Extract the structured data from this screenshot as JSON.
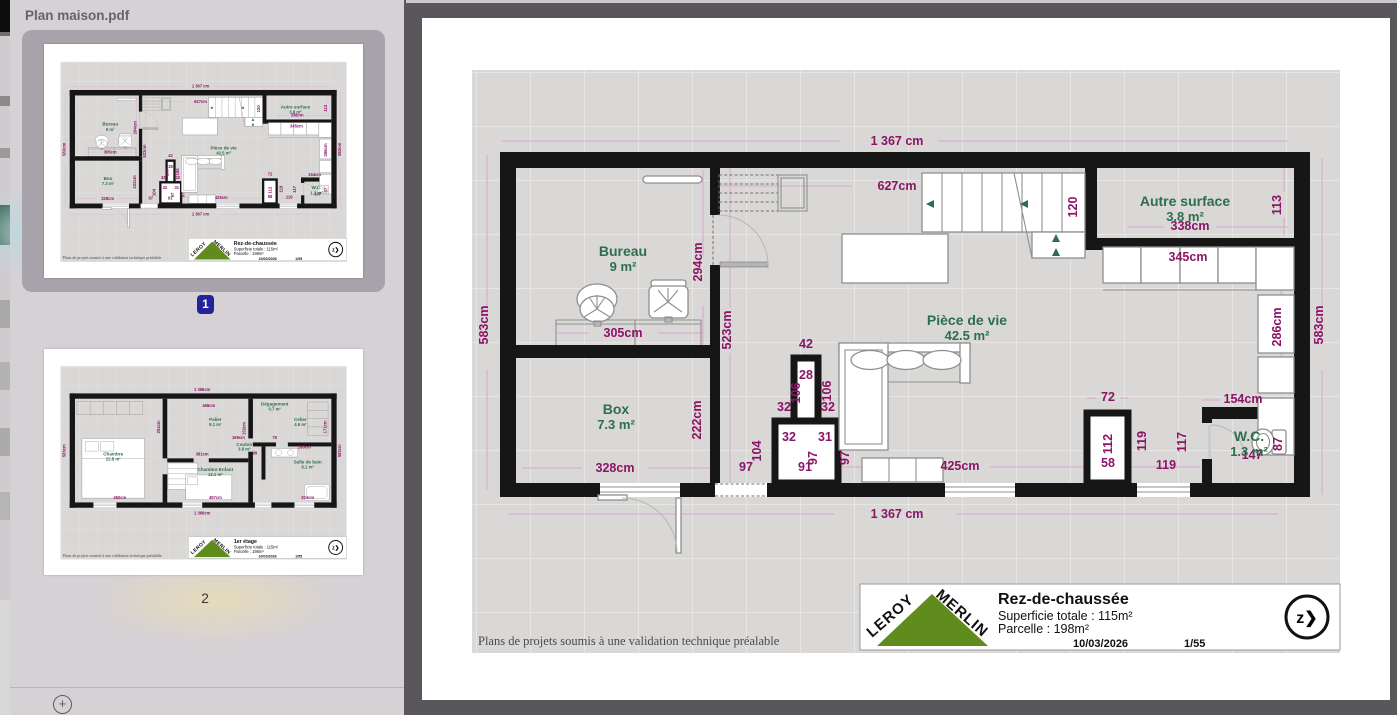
{
  "window": {
    "sidebar_title": "Plan maison.pdf"
  },
  "sidebar": {
    "pages": [
      {
        "number": "1",
        "selected": true
      },
      {
        "number": "2",
        "selected": false
      }
    ]
  },
  "colors": {
    "dimension_text": "#8c1468",
    "room_text": "#2c6e4e",
    "wall": "#161616",
    "page_badge_blue": "#23239b",
    "logo_green": "#5f8c1d",
    "viewer_background": "#59575b"
  },
  "page1": {
    "footer_note": "Plans de projets soumis à une validation technique préalable",
    "title_block": {
      "brand_top": "LEROY",
      "brand_bottom": "MERLIN",
      "title": "Rez-de-chaussée",
      "line1": "Superficie totale : 115m²",
      "line2": "Parcelle : 198m²",
      "date": "10/03/2026",
      "page_ref": "1/55",
      "compass": "z❯"
    },
    "rooms": [
      {
        "name": "Bureau",
        "area": "9 m²",
        "x": 201,
        "y": 238
      },
      {
        "name": "Box",
        "area": "7.3 m²",
        "x": 194,
        "y": 396
      },
      {
        "name": "Pièce de vie",
        "area": "42.5 m²",
        "x": 545,
        "y": 307
      },
      {
        "name": "Autre surface",
        "area": "3.8 m²",
        "x": 763,
        "y": 188
      },
      {
        "name": "W.C.",
        "area": "1.3 m²",
        "x": 827,
        "y": 423
      }
    ],
    "dims": [
      {
        "t": "1 367 cm",
        "x": 475,
        "y": 127
      },
      {
        "t": "1 367 cm",
        "x": 475,
        "y": 500
      },
      {
        "t": "583cm",
        "x": 66,
        "y": 307,
        "r": -90
      },
      {
        "t": "583cm",
        "x": 901,
        "y": 307,
        "r": -90
      },
      {
        "t": "627cm",
        "x": 475,
        "y": 172
      },
      {
        "t": "294cm",
        "x": 280,
        "y": 244,
        "r": -90
      },
      {
        "t": "523cm",
        "x": 309,
        "y": 312,
        "r": -90
      },
      {
        "t": "305cm",
        "x": 201,
        "y": 319
      },
      {
        "t": "222cm",
        "x": 279,
        "y": 402,
        "r": -90
      },
      {
        "t": "328cm",
        "x": 193,
        "y": 454
      },
      {
        "t": "120",
        "x": 655,
        "y": 189,
        "r": -90
      },
      {
        "t": "113",
        "x": 859,
        "y": 187,
        "r": -90
      },
      {
        "t": "42",
        "x": 384,
        "y": 330
      },
      {
        "t": "28",
        "x": 384,
        "y": 361
      },
      {
        "t": "106",
        "x": 378,
        "y": 375,
        "r": -90
      },
      {
        "t": "106",
        "x": 409,
        "y": 373,
        "r": -90
      },
      {
        "t": "32",
        "x": 362,
        "y": 393
      },
      {
        "t": "32",
        "x": 406,
        "y": 393
      },
      {
        "t": "32",
        "x": 367,
        "y": 423
      },
      {
        "t": "31",
        "x": 403,
        "y": 423
      },
      {
        "t": "104",
        "x": 339,
        "y": 433,
        "r": -90
      },
      {
        "t": "97",
        "x": 324,
        "y": 453
      },
      {
        "t": "97",
        "x": 395,
        "y": 440,
        "r": -90
      },
      {
        "t": "97",
        "x": 427,
        "y": 440,
        "r": -90
      },
      {
        "t": "91",
        "x": 383,
        "y": 453
      },
      {
        "t": "425cm",
        "x": 538,
        "y": 452
      },
      {
        "t": "345cm",
        "x": 766,
        "y": 243
      },
      {
        "t": "338cm",
        "x": 768,
        "y": 212
      },
      {
        "t": "286cm",
        "x": 859,
        "y": 309,
        "r": -90
      },
      {
        "t": "154cm",
        "x": 821,
        "y": 385
      },
      {
        "t": "72",
        "x": 686,
        "y": 383
      },
      {
        "t": "112",
        "x": 690,
        "y": 426,
        "r": -90
      },
      {
        "t": "58",
        "x": 686,
        "y": 449
      },
      {
        "t": "119",
        "x": 724,
        "y": 423,
        "r": -90
      },
      {
        "t": "117",
        "x": 764,
        "y": 424,
        "r": -90
      },
      {
        "t": "119",
        "x": 744,
        "y": 451
      },
      {
        "t": "147",
        "x": 830,
        "y": 441
      },
      {
        "t": "87",
        "x": 860,
        "y": 426,
        "r": -90
      }
    ]
  },
  "page2": {
    "footer_note": "Plans de projets soumis à une validation technique préalable",
    "title_block": {
      "brand_top": "LEROY",
      "brand_bottom": "MERLIN",
      "title": "1er étage",
      "line1": "Superficie totale : 115m²",
      "line2": "Parcelle : 198m²",
      "date": "10/03/2026",
      "page_ref": "1/55",
      "compass": "z❯"
    },
    "rooms": [
      {
        "name": "Chambre",
        "area": "22.8 m²",
        "x": 210,
        "y": 322
      },
      {
        "name": "Palier",
        "area": "9.1 m²",
        "x": 520,
        "y": 218
      },
      {
        "name": "Chambre Enfant",
        "area": "12.1 m²",
        "x": 520,
        "y": 368
      },
      {
        "name": "Celier",
        "area": "4.9 m²",
        "x": 778,
        "y": 218
      },
      {
        "name": "Salle de bain",
        "area": "6.1 m²",
        "x": 800,
        "y": 345
      },
      {
        "name": "Dégagement",
        "area": "0.7 m²",
        "x": 700,
        "y": 170
      },
      {
        "name": "Couloir",
        "area": "3.8 m²",
        "x": 608,
        "y": 292
      }
    ],
    "dims": [
      {
        "t": "1 366cm",
        "x": 480,
        "y": 127
      },
      {
        "t": "1 366cm",
        "x": 480,
        "y": 500
      },
      {
        "t": "583cm",
        "x": 66,
        "y": 307,
        "r": -90
      },
      {
        "t": "583cm",
        "x": 901,
        "y": 307,
        "r": -90
      },
      {
        "t": "468cm",
        "x": 500,
        "y": 175
      },
      {
        "t": "254cm",
        "x": 352,
        "y": 235,
        "r": -90
      },
      {
        "t": "381cm",
        "x": 480,
        "y": 322
      },
      {
        "t": "169cm",
        "x": 590,
        "y": 272
      },
      {
        "t": "152cm",
        "x": 612,
        "y": 240,
        "r": -90
      },
      {
        "t": "457cm",
        "x": 520,
        "y": 452
      },
      {
        "t": "450cm",
        "x": 230,
        "y": 452
      },
      {
        "t": "280cm",
        "x": 790,
        "y": 300
      },
      {
        "t": "171cm",
        "x": 858,
        "y": 235,
        "r": -90
      },
      {
        "t": "204cm",
        "x": 800,
        "y": 452
      },
      {
        "t": "99",
        "x": 640,
        "y": 318
      },
      {
        "t": "78",
        "x": 700,
        "y": 272
      }
    ]
  }
}
